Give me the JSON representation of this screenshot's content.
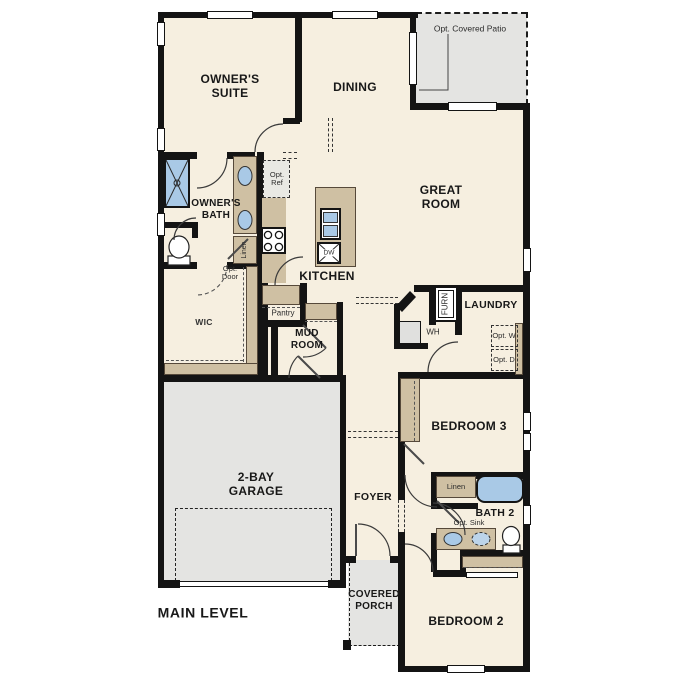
{
  "plan_title": "MAIN LEVEL",
  "rooms": {
    "owners_suite": "OWNER'S SUITE",
    "dining": "DINING",
    "great_room": "GREAT ROOM",
    "kitchen": "KITCHEN",
    "owners_bath": "OWNER'S BATH",
    "wic": "WIC",
    "pantry": "Pantry",
    "mud_room": "MUD ROOM",
    "laundry": "LAUNDRY",
    "bedroom_3": "BEDROOM 3",
    "bath_2": "BATH 2",
    "bedroom_2": "BEDROOM 2",
    "foyer": "FOYER",
    "covered_porch": "COVERED PORCH",
    "garage": "2-BAY GARAGE",
    "opt_patio": "Opt. Covered Patio"
  },
  "fixtures": {
    "opt_ref": "Opt. Ref",
    "opt_door": "Opt. Door",
    "linen_owners": "Linen",
    "linen_bath2": "Linen",
    "wh": "WH",
    "furn": "FURN",
    "opt_w": "Opt. W",
    "opt_d": "Opt. D",
    "opt_sink": "Opt. Sink",
    "dw": "DW"
  },
  "colors": {
    "wall": "#141414",
    "floor": "#f6efe0",
    "garage_floor": "#e4e4e2",
    "cabinet": "#cfc0a3",
    "plumbing_fixture": "#a9c9e6"
  }
}
